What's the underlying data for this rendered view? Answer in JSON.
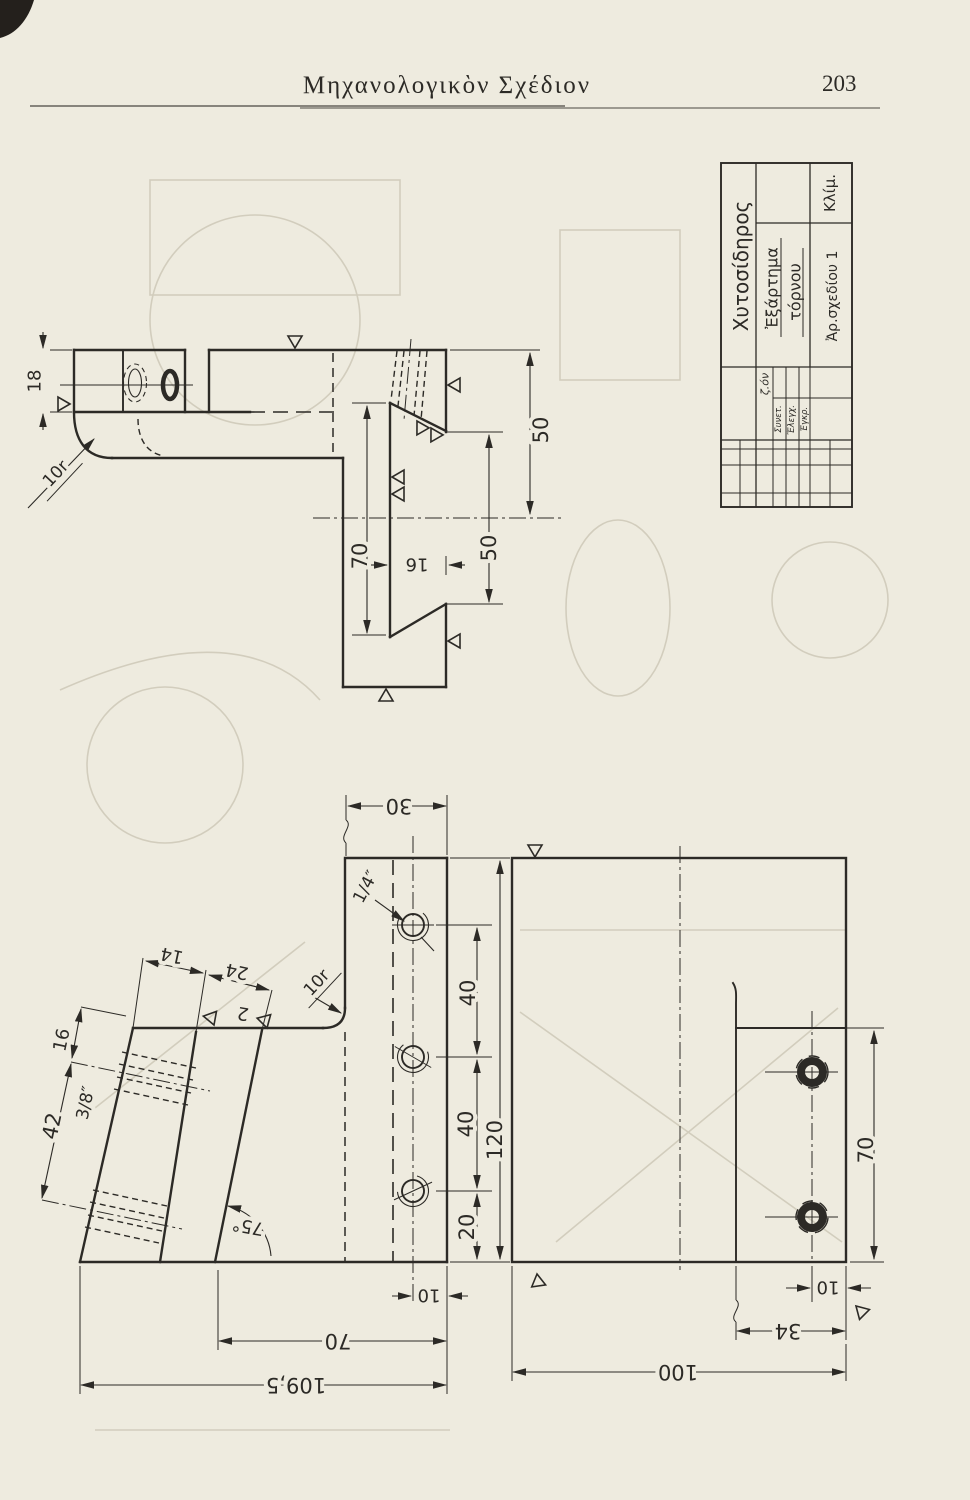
{
  "colors": {
    "paper": "#eeebdf",
    "ink": "#2c2a26",
    "ghost": "#d2cdbd"
  },
  "header": {
    "title": "Μηχανολογικὸν Σχέδιον",
    "page_number": "203"
  },
  "title_block": {
    "material": "Χυτοσίδηρος",
    "scale_label": "Κλίμ.",
    "part_name_line1": "Ἐξάρτημα",
    "part_name_line2": "τόρνου",
    "drawing_number": "Ἀρ.σχεδίου 1",
    "signature": "ζ.όν",
    "approvals": [
      "Συνετ.",
      "Ἔλεγχ.",
      "Ἐγκρ."
    ]
  },
  "side_view": {
    "d18": "18",
    "r10": "10r",
    "d50_upper": "50",
    "d50_lower": "50",
    "d70": "70",
    "d16": "16"
  },
  "plan_view": {
    "d30": "30",
    "thread_small": "1/4″",
    "d40_a": "40",
    "d40_b": "40",
    "d120": "120",
    "d20": "20",
    "d10": "10",
    "d70": "70",
    "d109_5": "109,5",
    "d42": "42",
    "thread_large": "3/8″",
    "d16": "16",
    "d14": "14",
    "d24": "24",
    "angle": "75°",
    "r10": "10r",
    "surface_note": "2"
  },
  "end_view": {
    "d70": "70",
    "d10": "10",
    "d34": "34",
    "d100": "100"
  }
}
